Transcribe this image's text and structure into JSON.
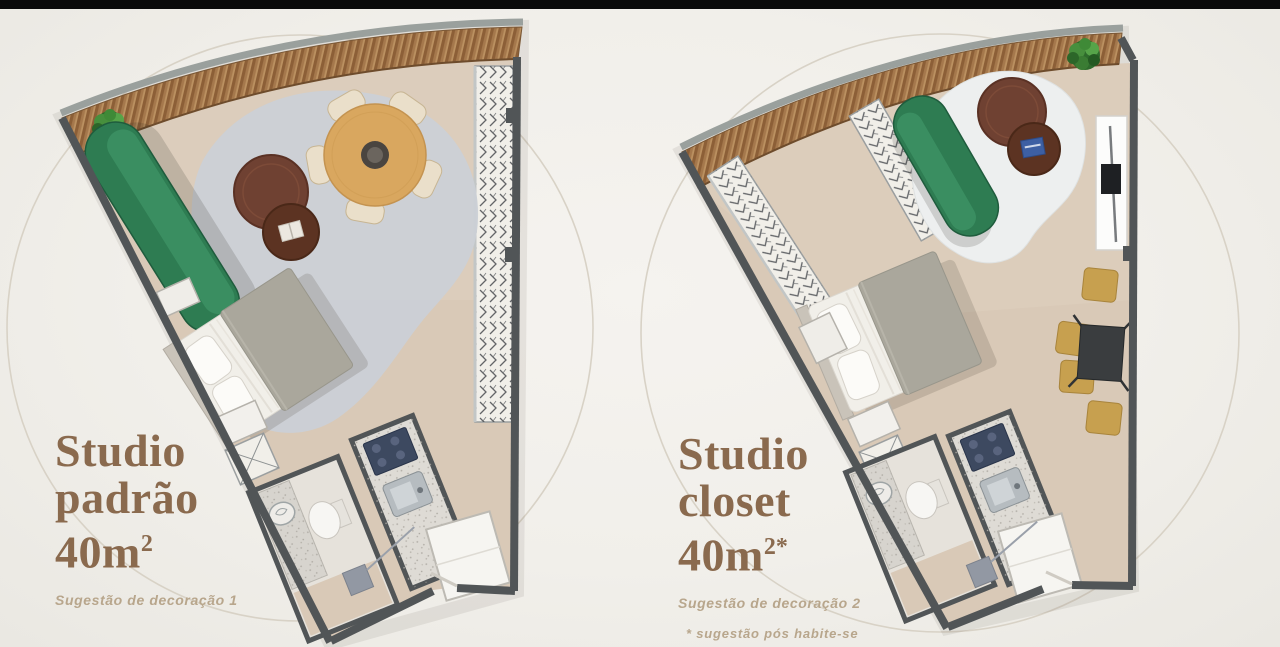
{
  "canvas": {
    "background": "#f1efea",
    "top_bar_color": "#0a0a0a"
  },
  "plans": [
    {
      "id": "studio-padrao",
      "title_lines": [
        "Studio",
        "padrão"
      ],
      "area": "40m",
      "area_superscript": "2",
      "subtitle": "Sugestão de decoração 1",
      "footnote": "",
      "furniture": [
        "wood-deck-balcony",
        "potted-plant",
        "green-chaise-sofa",
        "round-gray-rug",
        "coffee-table-pair",
        "round-dining-table",
        "dining-chairs-x5",
        "double-bed",
        "bedside-tables",
        "wardrobe-trunk",
        "curtain-closet-strip",
        "bathroom-sink-counter",
        "toilet",
        "kitchen-counter",
        "cooktop",
        "kitchen-sink",
        "fridge",
        "entry-door",
        "entry-mat"
      ]
    },
    {
      "id": "studio-closet",
      "title_lines": [
        "Studio",
        "closet"
      ],
      "area": "40m",
      "area_superscript": "2*",
      "subtitle": "Sugestão de decoração 2",
      "footnote": "* sugestão pós habite-se",
      "furniture": [
        "wood-deck-balcony",
        "potted-plant",
        "closet-wardrobe-strips",
        "green-sofa",
        "white-area-rug",
        "coffee-table-pair",
        "tv-sideboard",
        "square-dining-table",
        "dining-chairs-x4",
        "double-bed",
        "bedside-tables",
        "wardrobe-trunk",
        "bathroom-sink-counter",
        "toilet",
        "kitchen-counter",
        "cooktop",
        "kitchen-sink",
        "fridge",
        "entry-door",
        "entry-mat"
      ]
    }
  ],
  "palette": {
    "title_text": "#8a6a4e",
    "subtitle_text": "#b8a68c",
    "wall": "#515557",
    "floor": "#d9c9b7",
    "deck_wood": "#a5784c",
    "sofa_green": "#2e7c52",
    "rug_gray": "#cbd0d6",
    "rug_white": "#edefef",
    "dining_wood": "#d9a75f",
    "chair_tan": "#c7a04f",
    "cooktop_navy": "#3d4960",
    "accent_circle": "#d8d2c6"
  }
}
